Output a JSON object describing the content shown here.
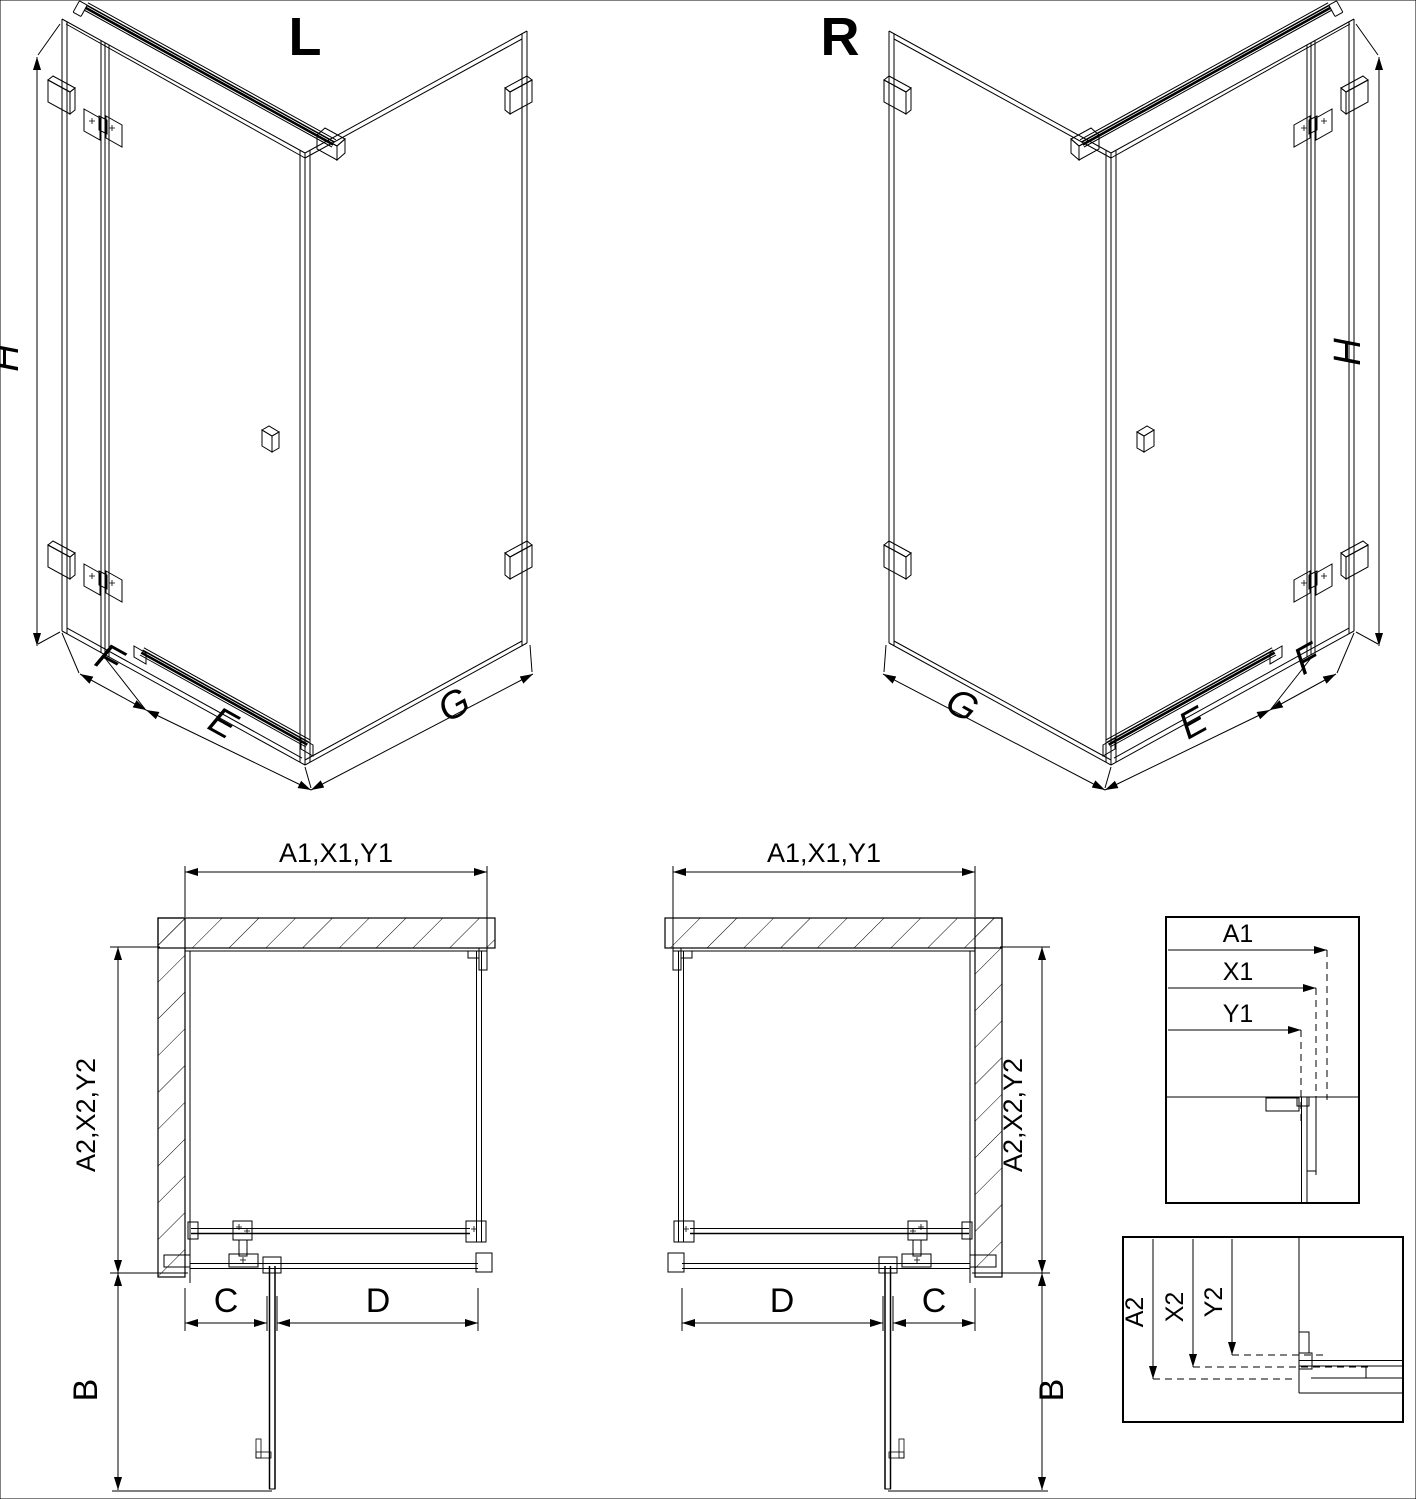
{
  "meta": {
    "background": "#ffffff",
    "line_color": "#000000"
  },
  "iso_left": {
    "variant": "L",
    "dim_height": "H",
    "dim_side_panel": "F",
    "dim_door": "E",
    "dim_return_panel": "G"
  },
  "iso_right": {
    "variant": "R",
    "dim_height": "H",
    "dim_side_panel": "F",
    "dim_door": "E",
    "dim_return_panel": "G"
  },
  "plan_left": {
    "dim_width": "A1,X1,Y1",
    "dim_depth": "A2,X2,Y2",
    "dim_fixed_segment": "C",
    "dim_door_segment": "D",
    "dim_door_swing": "B"
  },
  "plan_right": {
    "dim_width": "A1,X1,Y1",
    "dim_depth": "A2,X2,Y2",
    "dim_fixed_segment": "C",
    "dim_door_segment": "D",
    "dim_door_swing": "B"
  },
  "detail_width": {
    "dim_total": "A1",
    "dim_mid": "X1",
    "dim_inner": "Y1"
  },
  "detail_depth": {
    "dim_total": "A2",
    "dim_mid": "X2",
    "dim_inner": "Y2"
  }
}
